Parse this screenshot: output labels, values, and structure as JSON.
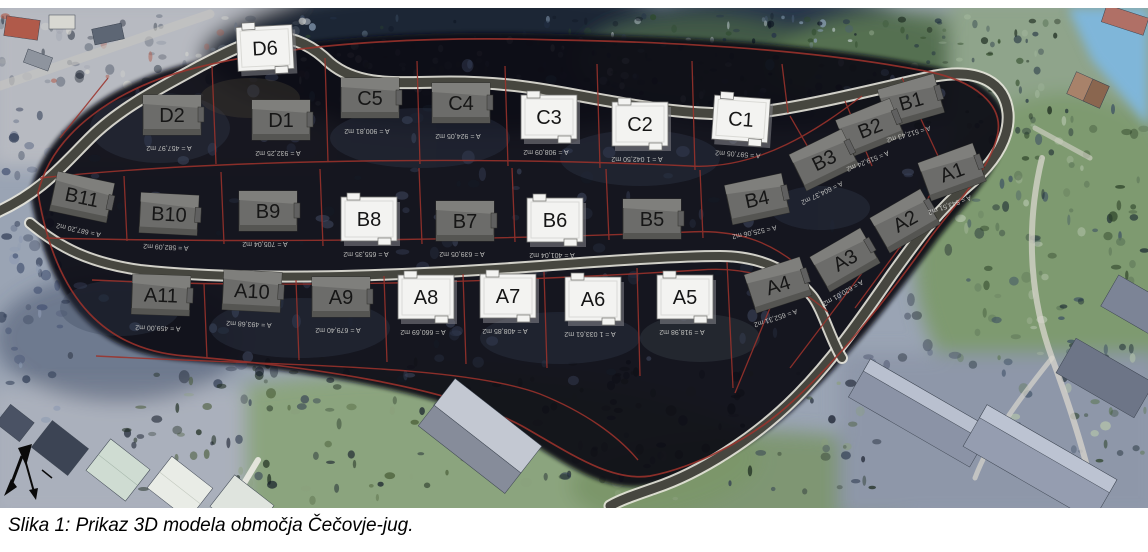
{
  "figure": {
    "caption": "Slika 1: Prikaz 3D modela območja Čečovje-jug."
  },
  "map": {
    "colors": {
      "parcel_boundary_red": "#9c332c",
      "house_model_white": "#f3f3f1",
      "house_model_gray": "#6c6c6a",
      "road_dark": "#46463f",
      "water_blue": "#7fb6d9"
    }
  },
  "parcels": [
    {
      "label": "D6",
      "x": 265,
      "y": 40,
      "rot": -3,
      "style": "white",
      "area_text": ""
    },
    {
      "label": "D2",
      "x": 172,
      "y": 107,
      "rot": 0,
      "style": "gray",
      "area_text": "A = 457,97 m2"
    },
    {
      "label": "D1",
      "x": 281,
      "y": 112,
      "rot": 0,
      "style": "gray",
      "area_text": "A = 932,25 m2"
    },
    {
      "label": "C5",
      "x": 370,
      "y": 90,
      "rot": 0,
      "style": "gray",
      "area_text": "A = 900,81 m2"
    },
    {
      "label": "C4",
      "x": 461,
      "y": 95,
      "rot": 0,
      "style": "gray",
      "area_text": "A = 924,05 m2"
    },
    {
      "label": "C3",
      "x": 549,
      "y": 109,
      "rot": 0,
      "style": "white",
      "area_text": "A = 908,09 m2"
    },
    {
      "label": "C2",
      "x": 640,
      "y": 116,
      "rot": 0,
      "style": "white",
      "area_text": "A = 1 042,50 m2"
    },
    {
      "label": "C1",
      "x": 741,
      "y": 111,
      "rot": 4,
      "style": "white",
      "area_text": "A = 597,05 m2"
    },
    {
      "label": "B1",
      "x": 911,
      "y": 93,
      "rot": -16,
      "style": "gray",
      "area_text": "A = 512,43 m2"
    },
    {
      "label": "B2",
      "x": 870,
      "y": 120,
      "rot": -22,
      "style": "gray",
      "area_text": "A = 519,24 m2"
    },
    {
      "label": "B3",
      "x": 824,
      "y": 152,
      "rot": -26,
      "style": "gray",
      "area_text": "A = 604,37 m2"
    },
    {
      "label": "A1",
      "x": 952,
      "y": 164,
      "rot": -20,
      "style": "gray",
      "area_text": "A = 543,51 m2"
    },
    {
      "label": "A2",
      "x": 905,
      "y": 213,
      "rot": -30,
      "style": "gray",
      "area_text": ""
    },
    {
      "label": "B11",
      "x": 82,
      "y": 189,
      "rot": 12,
      "style": "gray",
      "area_text": "A = 687,20 m2"
    },
    {
      "label": "B10",
      "x": 169,
      "y": 206,
      "rot": 3,
      "style": "gray",
      "area_text": "A = 582,09 m2"
    },
    {
      "label": "B9",
      "x": 268,
      "y": 203,
      "rot": 0,
      "style": "gray",
      "area_text": "A = 705,04 m2"
    },
    {
      "label": "B8",
      "x": 369,
      "y": 211,
      "rot": 0,
      "style": "white",
      "area_text": "A = 655,35 m2"
    },
    {
      "label": "B7",
      "x": 465,
      "y": 213,
      "rot": 0,
      "style": "gray",
      "area_text": "A = 639,05 m2"
    },
    {
      "label": "B6",
      "x": 555,
      "y": 212,
      "rot": 0,
      "style": "white",
      "area_text": "A = 401,04 m2"
    },
    {
      "label": "B5",
      "x": 652,
      "y": 211,
      "rot": 0,
      "style": "gray",
      "area_text": ""
    },
    {
      "label": "B4",
      "x": 757,
      "y": 191,
      "rot": -12,
      "style": "gray",
      "area_text": "A = 525,06 m2"
    },
    {
      "label": "A11",
      "x": 161,
      "y": 287,
      "rot": 2,
      "style": "gray",
      "area_text": "A = 459,00 m2"
    },
    {
      "label": "A10",
      "x": 252,
      "y": 283,
      "rot": 3,
      "style": "gray",
      "area_text": "A = 493,68 m2"
    },
    {
      "label": "A9",
      "x": 341,
      "y": 289,
      "rot": 0,
      "style": "gray",
      "area_text": "A = 679,40 m2"
    },
    {
      "label": "A8",
      "x": 426,
      "y": 289,
      "rot": 0,
      "style": "white",
      "area_text": "A = 660,69 m2"
    },
    {
      "label": "A7",
      "x": 508,
      "y": 288,
      "rot": 0,
      "style": "white",
      "area_text": "A = 408,85 m2"
    },
    {
      "label": "A6",
      "x": 593,
      "y": 291,
      "rot": 0,
      "style": "white",
      "area_text": "A = 1 033,61 m2"
    },
    {
      "label": "A5",
      "x": 685,
      "y": 289,
      "rot": 0,
      "style": "white",
      "area_text": "A = 918,98 m2"
    },
    {
      "label": "A4",
      "x": 778,
      "y": 277,
      "rot": -18,
      "style": "gray",
      "area_text": "A = 652,31 m2"
    },
    {
      "label": "A3",
      "x": 845,
      "y": 252,
      "rot": -30,
      "style": "gray",
      "area_text": "A = 620,01 m2"
    }
  ]
}
